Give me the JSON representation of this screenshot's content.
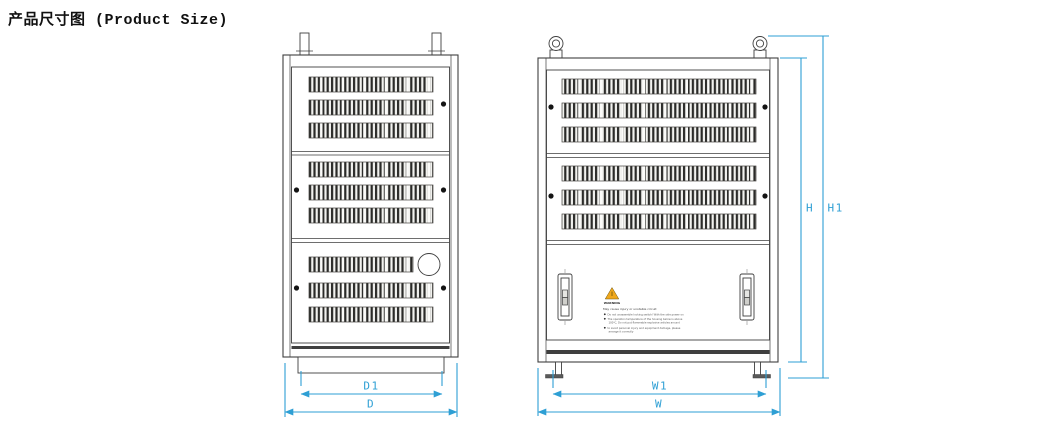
{
  "title": "产品尺寸图 (Product Size)",
  "drawing": {
    "type": "technical-dimension-diagram",
    "views": {
      "side": {
        "label": "side-view",
        "dims": {
          "inner_width": "D1",
          "outer_width": "D"
        }
      },
      "front": {
        "label": "front-view",
        "dims": {
          "inner_width": "W1",
          "outer_width": "W",
          "body_height": "H",
          "total_height": "H1"
        }
      }
    },
    "colors": {
      "dimension_line": "#2E9FD4",
      "outline": "#3F3F3F",
      "warning_triangle": "#F0A81C"
    }
  },
  "warning_label": {
    "heading": "WARNING",
    "subtitle": "May cause injury or unstable circuit",
    "lines": [
      "Do not unassemble locking switch! With the side power on",
      "The operation temperature of the housing below is above",
      "100℃, Do not put flammable explosive articles around",
      "to avoid personal injury and equipment damage, please",
      "arrange it correctly"
    ]
  }
}
